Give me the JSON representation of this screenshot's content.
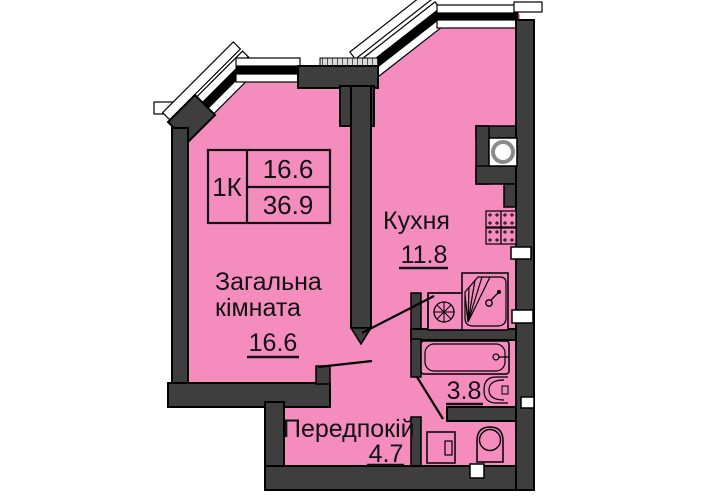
{
  "unit": {
    "type_label": "1К",
    "living_area": "16.6",
    "total_area": "36.9"
  },
  "rooms": {
    "living": {
      "name_line1": "Загальна",
      "name_line2": "кімната",
      "area": "16.6"
    },
    "kitchen": {
      "name": "Кухня",
      "area": "11.8"
    },
    "bathroom": {
      "area": "3.8"
    },
    "hallway": {
      "name": "Передпокій",
      "area": "4.7"
    }
  },
  "colors": {
    "room_fill": "#F48CBE",
    "wall": "#3E3E3E",
    "outline": "#000000",
    "window_white": "#FFFFFF",
    "sill_hatch": "#DADADA",
    "background": "#FFFFFF"
  },
  "icons": [
    "sink-icon",
    "stove-icon",
    "fan-icon",
    "kitchen-sink-icon",
    "bathtub-icon",
    "washbasin-icon",
    "toilet-icon",
    "washing-machine-icon",
    "window-band",
    "parapet-line",
    "vent-block",
    "door-swing-line"
  ]
}
